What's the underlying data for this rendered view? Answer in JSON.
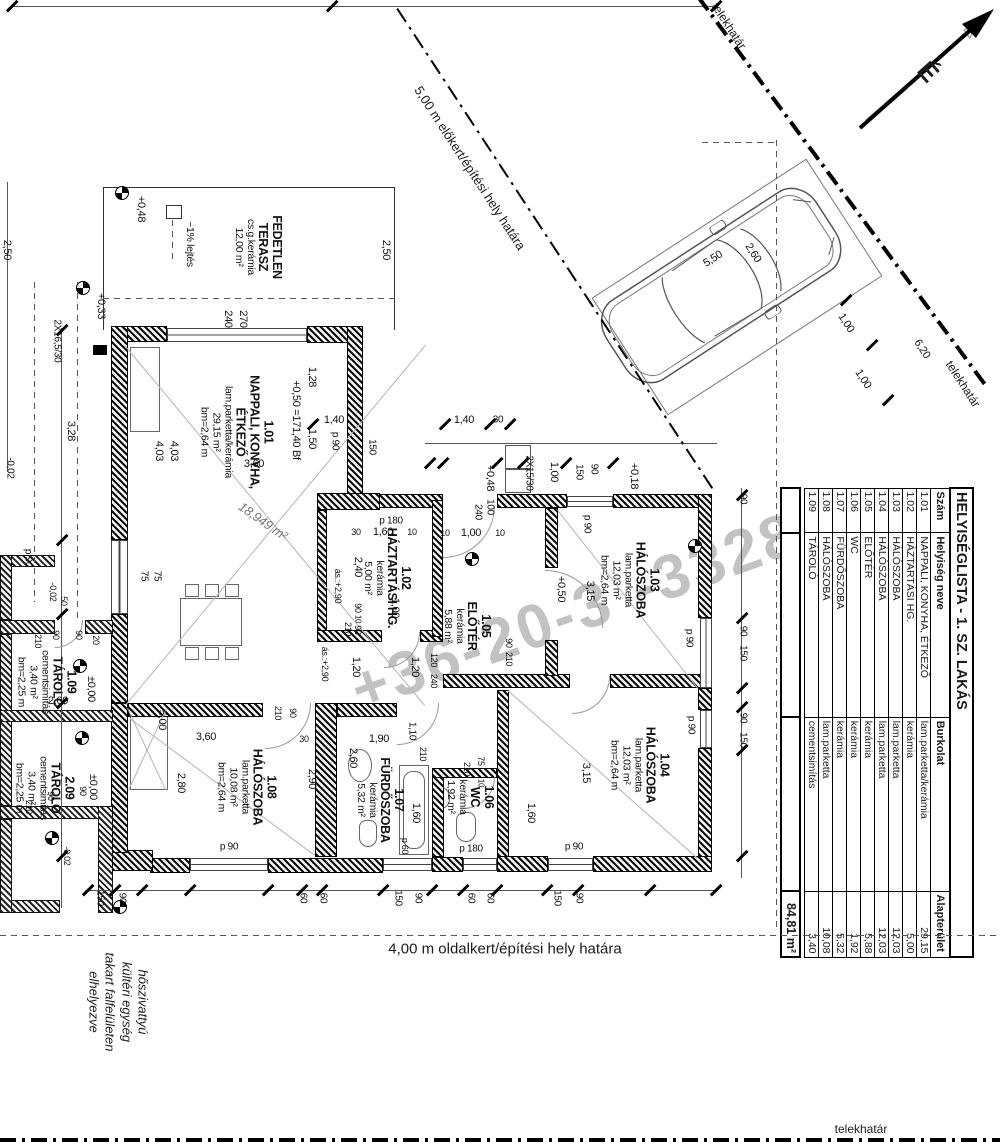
{
  "meta": {
    "drawing_type": "floor plan",
    "language": "hu"
  },
  "north": {
    "label": "É"
  },
  "boundaries": {
    "front_setback": "5,00 m előkert/építési hely határa",
    "side_setback": "4,00 m oldalkert/építési hely határa",
    "property_line_top": "telekhatár",
    "property_line_right": "telekhatár",
    "property_line_bottom": "telekhatár"
  },
  "note": {
    "lines": [
      "hőszivattyú",
      "kültéri egység",
      "takart falfelületen",
      "elhelyezve"
    ]
  },
  "watermark": {
    "part1": "+36-20-3",
    "part2": "-3328"
  },
  "car": {
    "length": "5,50",
    "width": "2,60"
  },
  "table": {
    "title": "HELYISÉGLISTA - 1. SZ. LAKÁS",
    "columns": [
      "Szám",
      "Helyiség neve",
      "Burkolat",
      "Alapterület"
    ],
    "rows": [
      [
        "1.01",
        "NAPPALI, KONYHA, ÉTKEZŐ",
        "lam.parketta/kerámia",
        "29,15"
      ],
      [
        "1.02",
        "HÁZTARTÁSI HG.",
        "kerámia",
        "5,00"
      ],
      [
        "1.03",
        "HÁLÓSZOBA",
        "lam.parketta",
        "12,03"
      ],
      [
        "1.04",
        "HÁLÓSZOBA",
        "lam.parketta",
        "12,03"
      ],
      [
        "1.05",
        "ELŐTÉR",
        "kerámia",
        "5,88"
      ],
      [
        "1.06",
        "WC",
        "kerámia",
        "1,92"
      ],
      [
        "1.07",
        "FÜRDŐSZOBA",
        "kerámia",
        "5,32"
      ],
      [
        "1.08",
        "HÁLÓSZOBA",
        "lam.parketta",
        "10,08"
      ],
      [
        "1.09",
        "TÁROLÓ",
        "cementsimítás",
        "3,40"
      ]
    ],
    "total": "84,81 m²"
  },
  "room_labels": [
    {
      "x": 258,
      "y": 247,
      "bold": [
        "FEDETLEN",
        "TERASZ"
      ],
      "small": [
        "cs.g.kerámia",
        "12,00 m²"
      ]
    },
    {
      "x": 189,
      "y": 244,
      "bold": [],
      "small": [
        "~1% lejtés"
      ]
    },
    {
      "x": 237,
      "y": 432,
      "bold": [
        "1.01",
        "NAPPALI, KONYHA,",
        "ÉTKEZŐ"
      ],
      "small": [
        "lam.parketta/kerámia",
        "29,15 m²",
        "bm=2,64 m"
      ]
    },
    {
      "x": 387,
      "y": 578,
      "bold": [
        "1.02",
        "HÁZTARTÁSI HG."
      ],
      "small": [
        "kerámia",
        "5,00 m²"
      ]
    },
    {
      "x": 467,
      "y": 626,
      "bold": [
        "1.05",
        "ELŐTÉR"
      ],
      "small": [
        "kerámia",
        "5,88 m²"
      ]
    },
    {
      "x": 630,
      "y": 580,
      "bold": [
        "1.03",
        "HÁLÓSZOBA"
      ],
      "small": [
        "lam.parketta",
        "12,03 m²",
        "bm=2,64 m"
      ]
    },
    {
      "x": 640,
      "y": 765,
      "bold": [
        "1.04",
        "HÁLÓSZOBA"
      ],
      "small": [
        "lam.parketta",
        "12,03 m²",
        "bm=2,64 m"
      ]
    },
    {
      "x": 247,
      "y": 787,
      "bold": [
        "1.08",
        "HÁLÓSZOBA"
      ],
      "small": [
        "lam.parketta",
        "10,08 m²",
        "bm=2,64 m"
      ]
    },
    {
      "x": 380,
      "y": 800,
      "bold": [
        "1.07",
        "FÜRDŐSZOBA"
      ],
      "small": [
        "kerámia",
        "5,32 m²"
      ]
    },
    {
      "x": 470,
      "y": 797,
      "bold": [
        "1.06",
        "WC"
      ],
      "small": [
        "kerámia",
        "1,92 m²"
      ]
    },
    {
      "x": 47,
      "y": 682,
      "bold": [
        "1.09",
        "TÁROLÓ"
      ],
      "small": [
        "cementsimítás",
        "3,40 m²",
        "bm=2,25 m"
      ]
    },
    {
      "x": 45,
      "y": 788,
      "bold": [
        "2.09",
        "TÁROLÓ"
      ],
      "small": [
        "cementsimítás",
        "3,40 m²",
        "bm=2,25 m"
      ]
    }
  ],
  "dim_labels": [
    {
      "t": "+0,48",
      "x": 141,
      "y": 209,
      "r": 90
    },
    {
      "t": "270",
      "x": 243,
      "y": 319,
      "r": 90
    },
    {
      "t": "240",
      "x": 228,
      "y": 319,
      "r": 90
    },
    {
      "t": "2,50",
      "x": 386,
      "y": 250,
      "r": 90
    },
    {
      "t": "2,50",
      "x": 7,
      "y": 250,
      "r": 90
    },
    {
      "t": "+0,33",
      "x": 101,
      "y": 306,
      "r": 90
    },
    {
      "t": "2X16,5/30",
      "x": 57,
      "y": 341,
      "r": 90,
      "s": 10
    },
    {
      "t": "3,28",
      "x": 71,
      "y": 431,
      "r": 90
    },
    {
      "t": "-0,02",
      "x": 10,
      "y": 468,
      "r": 90,
      "s": 10
    },
    {
      "t": "+0,50 =171,40 Bf",
      "x": 296,
      "y": 420,
      "r": 90
    },
    {
      "t": "1,28",
      "x": 312,
      "y": 377,
      "r": 90
    },
    {
      "t": "1,50",
      "x": 312,
      "y": 439,
      "r": 90
    },
    {
      "t": "p 90",
      "x": 335,
      "y": 441,
      "r": 90,
      "s": 10
    },
    {
      "t": "150",
      "x": 372,
      "y": 447,
      "r": 90,
      "s": 10
    },
    {
      "t": "1,40",
      "x": 334,
      "y": 420,
      "r": 0
    },
    {
      "t": "1,40",
      "x": 464,
      "y": 420,
      "r": 0
    },
    {
      "t": "30",
      "x": 498,
      "y": 420,
      "r": 0,
      "s": 10
    },
    {
      "t": "4,03",
      "x": 159,
      "y": 451,
      "r": 90
    },
    {
      "t": "4,03",
      "x": 174,
      "y": 451,
      "r": 90
    },
    {
      "t": "3,60",
      "x": 254,
      "y": 464,
      "r": 0
    },
    {
      "t": "75",
      "x": 144,
      "y": 576,
      "r": 90,
      "s": 10
    },
    {
      "t": "75",
      "x": 157,
      "y": 576,
      "r": 90,
      "s": 10
    },
    {
      "t": "p 90",
      "x": 28,
      "y": 558,
      "r": 90,
      "s": 10
    },
    {
      "t": "18,949 m²",
      "x": 263,
      "y": 521,
      "r": 35,
      "s": 13,
      "i": 1
    },
    {
      "t": "2X15/30",
      "x": 529,
      "y": 473,
      "r": 90,
      "s": 10
    },
    {
      "t": "+0,48",
      "x": 490,
      "y": 478,
      "r": 90
    },
    {
      "t": "1,00",
      "x": 554,
      "y": 472,
      "r": 90
    },
    {
      "t": "150",
      "x": 579,
      "y": 472,
      "r": 90,
      "s": 10
    },
    {
      "t": "90",
      "x": 594,
      "y": 469,
      "r": 90,
      "s": 10
    },
    {
      "t": "+0,18",
      "x": 634,
      "y": 476,
      "r": 90
    },
    {
      "t": "240",
      "x": 478,
      "y": 512,
      "r": 90,
      "s": 10
    },
    {
      "t": "100",
      "x": 490,
      "y": 507,
      "r": 90,
      "s": 10
    },
    {
      "t": "10",
      "x": 445,
      "y": 533,
      "r": 0,
      "s": 9
    },
    {
      "t": "1,00",
      "x": 471,
      "y": 533,
      "r": 0
    },
    {
      "t": "10",
      "x": 500,
      "y": 533,
      "r": 0,
      "s": 9
    },
    {
      "t": "p 180",
      "x": 391,
      "y": 521,
      "r": 0,
      "s": 10
    },
    {
      "t": "30",
      "x": 356,
      "y": 532,
      "r": 0,
      "s": 9
    },
    {
      "t": "1,60",
      "x": 383,
      "y": 532,
      "r": 0
    },
    {
      "t": "10",
      "x": 412,
      "y": 532,
      "r": 0,
      "s": 9
    },
    {
      "t": "p 90",
      "x": 587,
      "y": 524,
      "r": 90,
      "s": 10
    },
    {
      "t": "+0,50",
      "x": 561,
      "y": 589,
      "r": 90
    },
    {
      "t": "2,40",
      "x": 358,
      "y": 567,
      "r": 90
    },
    {
      "t": "ás.:+2,90",
      "x": 338,
      "y": 586,
      "r": 90,
      "s": 9
    },
    {
      "t": "90",
      "x": 358,
      "y": 608,
      "r": 90,
      "s": 9
    },
    {
      "t": "10",
      "x": 358,
      "y": 619,
      "r": 90,
      "s": 8
    },
    {
      "t": "90",
      "x": 358,
      "y": 630,
      "r": 90,
      "s": 9
    },
    {
      "t": "1,00",
      "x": 395,
      "y": 608,
      "r": 90
    },
    {
      "t": "210",
      "x": 348,
      "y": 629,
      "r": 90,
      "s": 9
    },
    {
      "t": "ás.:+2,90",
      "x": 325,
      "y": 664,
      "r": 90,
      "s": 9
    },
    {
      "t": "1,20",
      "x": 356,
      "y": 667,
      "r": 90
    },
    {
      "t": "1,20",
      "x": 415,
      "y": 667,
      "r": 90
    },
    {
      "t": "120",
      "x": 434,
      "y": 660,
      "r": 90,
      "s": 9
    },
    {
      "t": "240",
      "x": 434,
      "y": 681,
      "r": 90,
      "s": 9
    },
    {
      "t": "90",
      "x": 509,
      "y": 643,
      "r": 90,
      "s": 9
    },
    {
      "t": "210",
      "x": 509,
      "y": 659,
      "r": 90,
      "s": 9
    },
    {
      "t": "3,15",
      "x": 590,
      "y": 591,
      "r": 90
    },
    {
      "t": "90",
      "x": 743,
      "y": 499,
      "r": 90,
      "s": 10
    },
    {
      "t": "90",
      "x": 743,
      "y": 631,
      "r": 90,
      "s": 10
    },
    {
      "t": "150",
      "x": 743,
      "y": 653,
      "r": 90,
      "s": 10
    },
    {
      "t": "p 90",
      "x": 689,
      "y": 638,
      "r": 90,
      "s": 10
    },
    {
      "t": "3,15",
      "x": 586,
      "y": 773,
      "r": 90
    },
    {
      "t": "1,60",
      "x": 531,
      "y": 813,
      "r": 90
    },
    {
      "t": "p 90",
      "x": 691,
      "y": 725,
      "r": 90,
      "s": 10
    },
    {
      "t": "90",
      "x": 743,
      "y": 718,
      "r": 90,
      "s": 10
    },
    {
      "t": "150",
      "x": 743,
      "y": 740,
      "r": 90,
      "s": 10
    },
    {
      "t": "p 90",
      "x": 574,
      "y": 847,
      "r": 0,
      "s": 10
    },
    {
      "t": "5,00",
      "x": 162,
      "y": 720,
      "r": 90
    },
    {
      "t": "3,60",
      "x": 206,
      "y": 737,
      "r": 0
    },
    {
      "t": "2,80",
      "x": 181,
      "y": 783,
      "r": 90
    },
    {
      "t": "210",
      "x": 278,
      "y": 713,
      "r": 90,
      "s": 9
    },
    {
      "t": "90",
      "x": 293,
      "y": 713,
      "r": 90,
      "s": 9
    },
    {
      "t": "30",
      "x": 304,
      "y": 739,
      "r": 0,
      "s": 9
    },
    {
      "t": "2,90",
      "x": 312,
      "y": 779,
      "r": 90
    },
    {
      "t": "p 90",
      "x": 229,
      "y": 847,
      "r": 0,
      "s": 10
    },
    {
      "t": "1,90",
      "x": 379,
      "y": 739,
      "r": 0
    },
    {
      "t": "2,60",
      "x": 353,
      "y": 758,
      "r": 90
    },
    {
      "t": "1,10",
      "x": 412,
      "y": 731,
      "r": 90,
      "s": 10
    },
    {
      "t": "210",
      "x": 423,
      "y": 754,
      "r": 90,
      "s": 9
    },
    {
      "t": "210",
      "x": 467,
      "y": 769,
      "r": 90,
      "s": 9
    },
    {
      "t": "75",
      "x": 481,
      "y": 761,
      "r": 90,
      "s": 9
    },
    {
      "t": "10",
      "x": 481,
      "y": 783,
      "r": 90,
      "s": 8
    },
    {
      "t": "1,60",
      "x": 416,
      "y": 813,
      "r": 90
    },
    {
      "t": "p 60",
      "x": 405,
      "y": 846,
      "r": 90,
      "s": 9
    },
    {
      "t": "p 180",
      "x": 471,
      "y": 849,
      "r": 0,
      "s": 10
    },
    {
      "t": "150",
      "x": 100,
      "y": 898,
      "r": 90,
      "s": 10
    },
    {
      "t": "90",
      "x": 122,
      "y": 898,
      "r": 90,
      "s": 10
    },
    {
      "t": "60",
      "x": 303,
      "y": 898,
      "r": 90,
      "s": 10
    },
    {
      "t": "60",
      "x": 323,
      "y": 898,
      "r": 90,
      "s": 10
    },
    {
      "t": "150",
      "x": 398,
      "y": 898,
      "r": 90,
      "s": 10
    },
    {
      "t": "90",
      "x": 418,
      "y": 898,
      "r": 90,
      "s": 10
    },
    {
      "t": "60",
      "x": 471,
      "y": 898,
      "r": 90,
      "s": 10
    },
    {
      "t": "60",
      "x": 490,
      "y": 898,
      "r": 90,
      "s": 10
    },
    {
      "t": "150",
      "x": 557,
      "y": 898,
      "r": 90,
      "s": 10
    },
    {
      "t": "90",
      "x": 579,
      "y": 898,
      "r": 90,
      "s": 10
    },
    {
      "t": "50",
      "x": 64,
      "y": 601,
      "r": 90,
      "s": 9
    },
    {
      "t": "-0,02",
      "x": 53,
      "y": 592,
      "r": 90,
      "s": 9
    },
    {
      "t": "210",
      "x": 38,
      "y": 641,
      "r": 90,
      "s": 9
    },
    {
      "t": "90",
      "x": 56,
      "y": 635,
      "r": 90,
      "s": 9
    },
    {
      "t": "90",
      "x": 79,
      "y": 635,
      "r": 90,
      "s": 9
    },
    {
      "t": "20",
      "x": 96,
      "y": 640,
      "r": 90,
      "s": 9
    },
    {
      "t": "±0,00",
      "x": 91,
      "y": 689,
      "r": 90
    },
    {
      "t": "2,00",
      "x": 58,
      "y": 701,
      "r": 0
    },
    {
      "t": "±0,00",
      "x": 93,
      "y": 787,
      "r": 90
    },
    {
      "t": "90",
      "x": 51,
      "y": 796,
      "r": 90,
      "s": 9
    },
    {
      "t": "210",
      "x": 29,
      "y": 807,
      "r": 90,
      "s": 9
    },
    {
      "t": "90",
      "x": 83,
      "y": 791,
      "r": 90,
      "s": 9
    },
    {
      "t": "-0,02",
      "x": 67,
      "y": 856,
      "r": 90,
      "s": 9
    },
    {
      "t": "5,50",
      "x": 713,
      "y": 259,
      "r": -33
    },
    {
      "t": "2,60",
      "x": 753,
      "y": 253,
      "r": 57
    },
    {
      "t": "1,00",
      "x": 846,
      "y": 323,
      "r": 57
    },
    {
      "t": "1,00",
      "x": 863,
      "y": 379,
      "r": 57
    },
    {
      "t": "6,20",
      "x": 922,
      "y": 349,
      "r": 57
    }
  ]
}
